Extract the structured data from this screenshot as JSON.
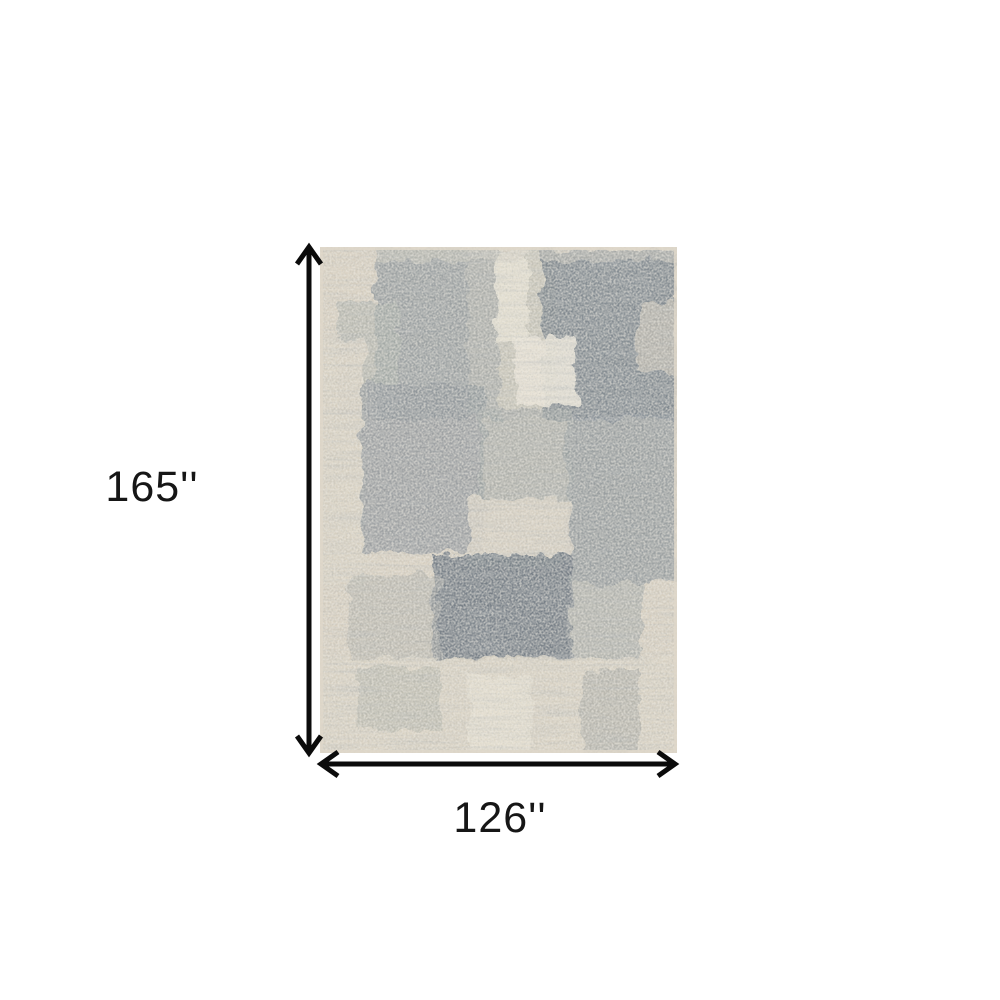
{
  "canvas": {
    "width": 1000,
    "height": 1000,
    "background": "#ffffff"
  },
  "diagram": {
    "kind": "rug-dimension-diagram",
    "vertical_dimension": {
      "label": "165''"
    },
    "horizontal_dimension": {
      "label": "126''"
    },
    "arrow_color": "#0b0b0b",
    "label_color": "#161616"
  },
  "rug": {
    "base_color": "#d7cfc0",
    "edge_color": "#ded7c9",
    "palette": {
      "beige": "#d7cfc0",
      "cream": "#e8e2d4",
      "light_gray": "#aeb0a9",
      "medium_gray": "#8f979a",
      "slate_gray": "#78828a",
      "dark_slate": "#6d7680"
    },
    "patches": [
      {
        "x": 55,
        "y": 0,
        "w": 125,
        "h": 172,
        "fill": "#8f979a",
        "o": 0.85
      },
      {
        "x": 18,
        "y": 55,
        "w": 60,
        "h": 115,
        "fill": "#a9ada8",
        "o": 0.65
      },
      {
        "x": 148,
        "y": 0,
        "w": 88,
        "h": 170,
        "fill": "#b9b9b0",
        "o": 0.55
      },
      {
        "x": 176,
        "y": 0,
        "w": 32,
        "h": 98,
        "fill": "#e7e1d3",
        "o": 0.9
      },
      {
        "x": 222,
        "y": 4,
        "w": 135,
        "h": 168,
        "fill": "#78828a",
        "o": 0.9
      },
      {
        "x": 196,
        "y": 90,
        "w": 60,
        "h": 68,
        "fill": "#e8e3d6",
        "o": 0.92
      },
      {
        "x": 0,
        "y": 92,
        "w": 46,
        "h": 245,
        "fill": "#d8d1c2",
        "o": 0.9
      },
      {
        "x": 42,
        "y": 138,
        "w": 122,
        "h": 168,
        "fill": "#8d9498",
        "o": 0.8
      },
      {
        "x": 246,
        "y": 168,
        "w": 111,
        "h": 168,
        "fill": "#8a9197",
        "o": 0.8
      },
      {
        "x": 160,
        "y": 162,
        "w": 92,
        "h": 95,
        "fill": "#9ba1a0",
        "o": 0.65
      },
      {
        "x": 148,
        "y": 252,
        "w": 102,
        "h": 68,
        "fill": "#d6cfc1",
        "o": 0.9
      },
      {
        "x": 113,
        "y": 308,
        "w": 140,
        "h": 104,
        "fill": "#6d7680",
        "o": 0.92
      },
      {
        "x": 28,
        "y": 328,
        "w": 92,
        "h": 84,
        "fill": "#a9aca6",
        "o": 0.55
      },
      {
        "x": 250,
        "y": 330,
        "w": 72,
        "h": 82,
        "fill": "#9aa0a0",
        "o": 0.6
      },
      {
        "x": 0,
        "y": 410,
        "w": 357,
        "h": 96,
        "fill": "#d8d1c2",
        "o": 0.85
      },
      {
        "x": 38,
        "y": 420,
        "w": 82,
        "h": 62,
        "fill": "#a8a9a1",
        "o": 0.5
      },
      {
        "x": 148,
        "y": 428,
        "w": 64,
        "h": 78,
        "fill": "#e4decf",
        "o": 0.85
      },
      {
        "x": 262,
        "y": 422,
        "w": 58,
        "h": 84,
        "fill": "#a0a39e",
        "o": 0.55
      },
      {
        "x": 318,
        "y": 55,
        "w": 39,
        "h": 70,
        "fill": "#c8c2b4",
        "o": 0.7
      },
      {
        "x": 55,
        "y": 0,
        "w": 302,
        "h": 14,
        "fill": "#cfccc0",
        "o": 0.5
      }
    ]
  }
}
